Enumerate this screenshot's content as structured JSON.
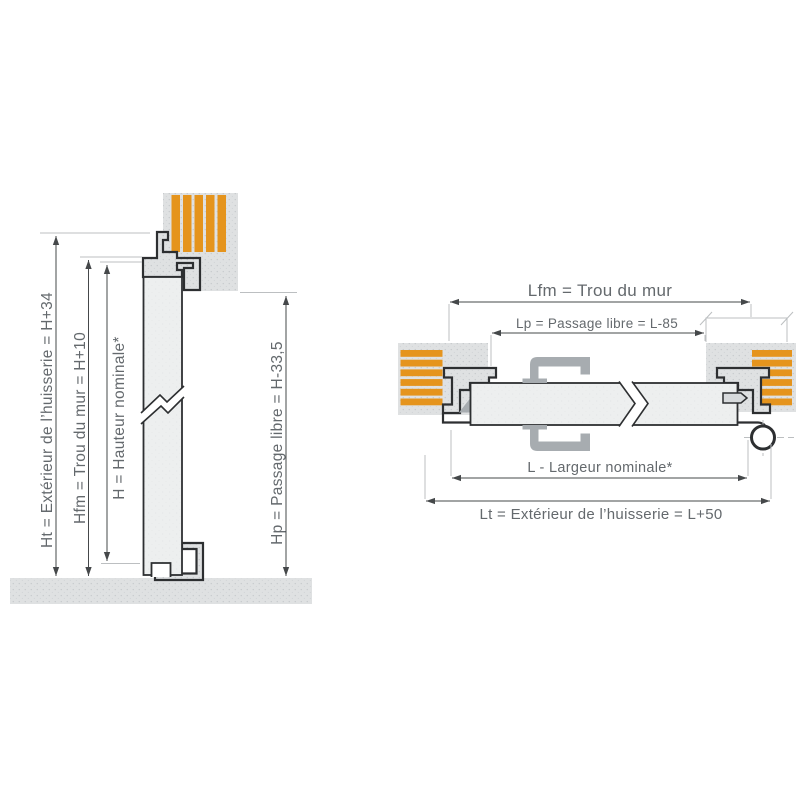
{
  "colors": {
    "background": "#ffffff",
    "orange": "#e5941d",
    "wall": "#dfe1e2",
    "wallDot": "#c8cbce",
    "door": "#edefef",
    "doorDot": "#dfe2e4",
    "outline": "#2d2f31",
    "bracket": "#a7acb0",
    "dimline": "#45484a",
    "refline": "#bcbfc1",
    "text": "#64696d"
  },
  "left_diagram": {
    "dimensions": [
      {
        "id": "ht",
        "label": "Ht = Extérieur de l’huisserie = H+34"
      },
      {
        "id": "hfm",
        "label": "Hfm = Trou du mur = H+10"
      },
      {
        "id": "h",
        "label": "H = Hauteur nominale*"
      },
      {
        "id": "hp",
        "label": "Hp = Passage libre = H-33,5"
      }
    ]
  },
  "right_diagram": {
    "dimensions": [
      {
        "id": "lfm",
        "label": "Lfm = Trou du mur"
      },
      {
        "id": "lp",
        "label": "Lp = Passage libre = L-85"
      },
      {
        "id": "l",
        "label": "L - Largeur nominale*"
      },
      {
        "id": "lt",
        "label": "Lt = Extérieur de l’huisserie = L+50"
      }
    ]
  }
}
